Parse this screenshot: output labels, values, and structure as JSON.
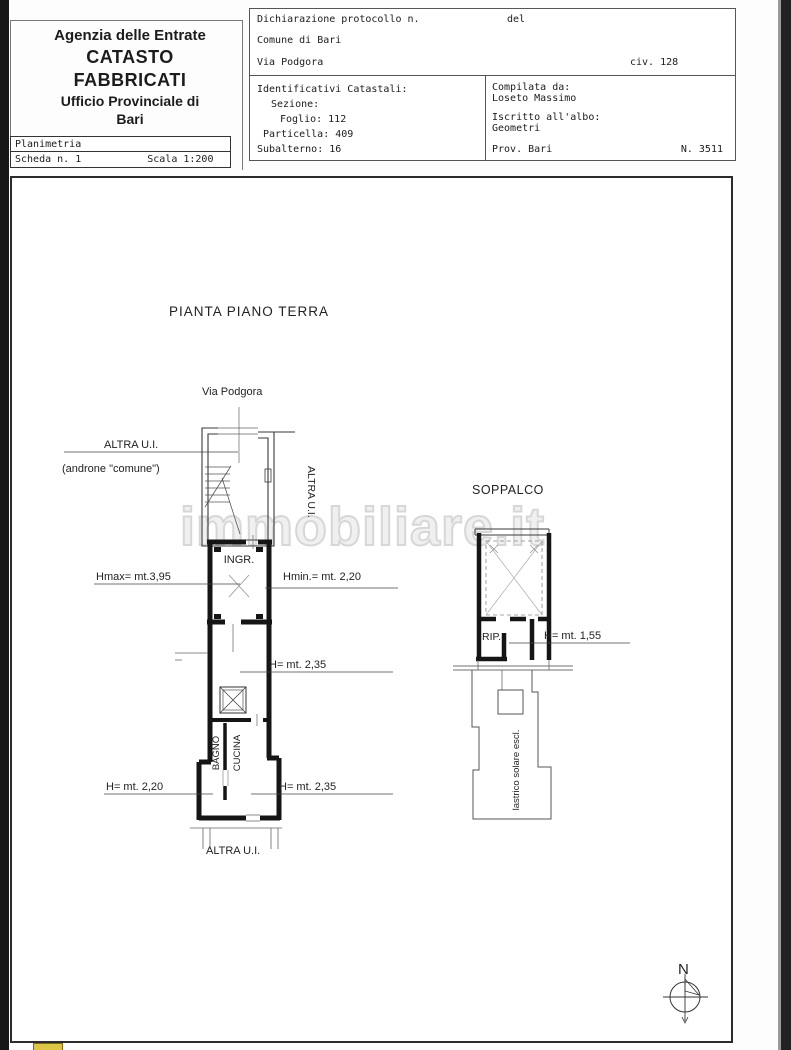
{
  "header": {
    "agency": {
      "line1": "Agenzia delle Entrate",
      "line2": "CATASTO FABBRICATI",
      "line3": "Ufficio Provinciale di",
      "line4": "Bari"
    },
    "planimetria": {
      "title": "Planimetria",
      "scheda": "Scheda n. 1",
      "scala": "Scala 1:200"
    },
    "declaration": {
      "protocol": "Dichiarazione protocollo n.",
      "del": "del",
      "comune": "Comune di Bari",
      "street": "Via Podgora",
      "civ": "civ. 128"
    },
    "identifiers": {
      "title": "Identificativi Catastali:",
      "sezione": "Sezione:",
      "foglio": "Foglio: 112",
      "particella": "Particella: 409",
      "subalterno": "Subalterno: 16"
    },
    "compiler": {
      "label": "Compilata da:",
      "name": "Loseto Massimo",
      "albo_label": "Iscritto all'albo:",
      "albo": "Geometri",
      "prov": "Prov. Bari",
      "num": "N. 3511"
    }
  },
  "plan": {
    "title": "PIANTA PIANO TERRA",
    "street_label": "Via Podgora",
    "labels": {
      "altra_ui_top": "ALTRA U.I.",
      "androne": "(androne \"comune\")",
      "altra_ui_right": "ALTRA U.I.",
      "ingr": "INGR.",
      "hmax": "Hmax= mt.3,95",
      "hmin": "Hmin.= mt. 2,20",
      "h235_upper": "H= mt. 2,35",
      "bagno": "BAGNO",
      "cucina": "CUCINA",
      "h220": "H= mt. 2,20",
      "h235_lower": "H= mt. 2,35",
      "altra_ui_bottom": "ALTRA U.I.",
      "soppalco": "SOPPALCO",
      "rip": "RIP.",
      "h155": "H= mt. 1,55",
      "lastrico": "lastrico solare escl.",
      "north": "N"
    },
    "watermark": "immobiliare.it"
  },
  "colors": {
    "page_bg": "#fdfdfd",
    "ink": "#1c1c1c",
    "watermark": "#d7d7d7",
    "side_strip_left": "#171717",
    "side_strip_right": "#222222",
    "highlight_yellow": "#ddc545"
  }
}
